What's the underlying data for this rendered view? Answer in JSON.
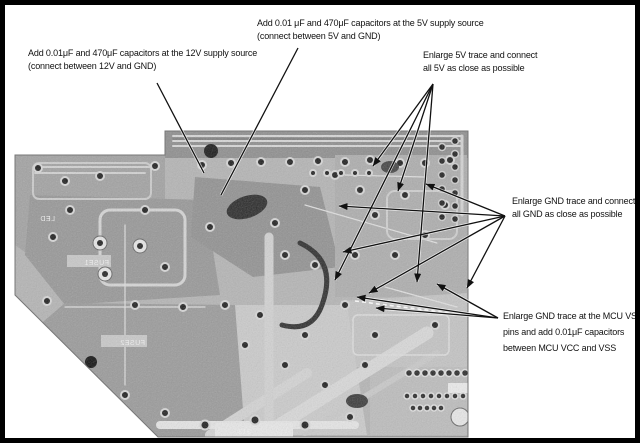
{
  "figure": {
    "type": "annotated-pcb-photo",
    "background": "#ffffff",
    "border_color": "#000000"
  },
  "annotations": {
    "cap_5v": {
      "line1": "Add 0.01 μF and 470μF capacitors at the 5V supply source",
      "line2": "(connect between 5V and GND)"
    },
    "cap_12v": {
      "line1": "Add 0.01μF and 470μF capacitors at the 12V supply source",
      "line2": "(connect between 12V and GND)"
    },
    "trace_5v": {
      "line1": "Enlarge 5V trace and connect",
      "line2": "all 5V as close as possible"
    },
    "trace_gnd": {
      "line1": "Enlarge GND trace and connect",
      "line2": "all GND as close as possible"
    },
    "mcu_vss": {
      "line1": "Enlarge GND trace at the MCU VSS",
      "line2": "pins and add 0.01μF capacitors",
      "line3": "between MCU VCC and VSS"
    }
  },
  "pcb": {
    "silkscreen": {
      "fuse1": "FUSE1",
      "fuse2": "FUSE2",
      "part_913": "913",
      "led": "LED"
    },
    "colors": {
      "base": "#b5b5b5",
      "patch_dark": "#8f8f8f",
      "trace_light": "#e3e3e3",
      "pad": "#1f1f1f",
      "component_dark": "#2b2b2b"
    }
  }
}
